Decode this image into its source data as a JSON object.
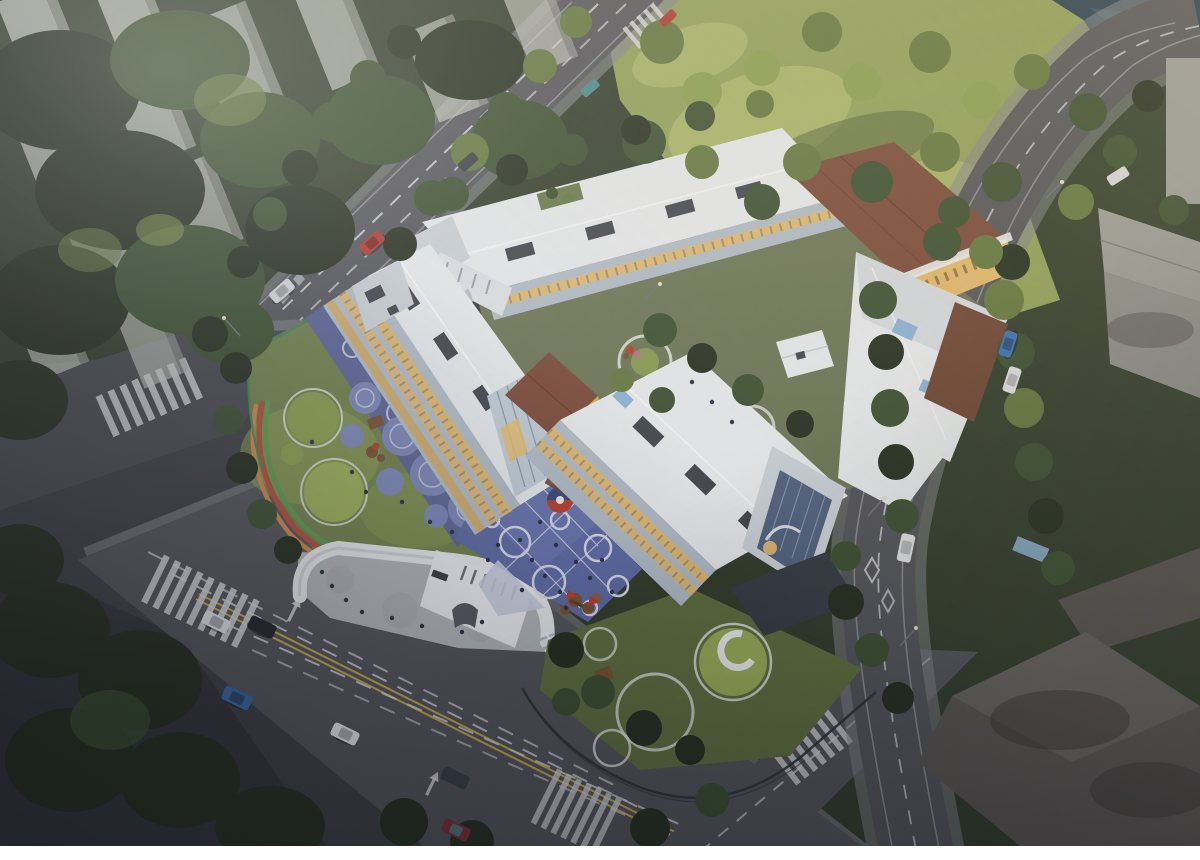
{
  "scene": {
    "description": "Aerial dusk rendering of a kindergarten campus: white pitched-roof wings around a courtyard, brown and yellow accent volumes, blue play court with white circles, circular play lawn with grass mounds and running track, curved white entrance gate with glass corridor, tree-lined roads with cars, ghosted residential towers, sunlit park with water edge, dark slab buildings",
    "time_of_day": "dusk",
    "text_content": "none"
  },
  "palette": {
    "asphalt": "#4b4c50",
    "plaza_dark": "#404145",
    "road": "#55565a",
    "road_edge": "#77797d",
    "sidewalk": "#84878a",
    "plaza_light": "#b3b6b8",
    "park": "#93a259",
    "park_sun": "#aeba6a",
    "park_shadow": "#55633a",
    "lawn": "#73824b",
    "lawn_sun": "#8ea353",
    "garden": "#60713f",
    "courtyard": "#6d7655",
    "tree_dark": "#26301f",
    "tree_mid": "#3c5030",
    "tree_lit": "#65783e",
    "tree_sun": "#8da050",
    "roof_white": "#e9eced",
    "roof_shade": "#d2d7db",
    "facade": "#b3bec7",
    "facade_light": "#ccd3d8",
    "facade_dark": "#98a3ad",
    "window_warm": "#e4ba6b",
    "dormer": "#41464c",
    "roof_brown": "#7b4a38",
    "wood": "#6f4733",
    "yellow": "#d9b14a",
    "glass": "#c3cfd7",
    "glass_blue": "#53637f",
    "skylight": "#8fb4d4",
    "court": "#5f6ca5",
    "pad": "#7d89b6",
    "pad_walk": "#5a64a0",
    "court_line": "#d9dde9",
    "court_white": "#c9cfdf",
    "track_red": "#b2503e",
    "track_green": "#5f9c4f",
    "track_orange": "#cc8a4a",
    "fence_green": "#3f8a52",
    "fence_dark": "#2e3338",
    "water": "#27404f",
    "water_light": "#3f6173",
    "tower": "#c7cac2",
    "tower_side": "#a3a69e",
    "mark_white": "#d9dadc",
    "mark_yellow": "#c4a94e",
    "slab": "#5a5651",
    "slab_light": "#6b6761",
    "bldg_gray": "#90918c",
    "bldg_gray_light": "#9d9e99",
    "mound": "#8ba04f",
    "mound_sun": "#9cb058",
    "ring_white": "#e3e7e3",
    "equip_brown": "#7a5232",
    "equip_red": "#b8402e",
    "people": "#2b3140",
    "glow": "#e8c070",
    "canopy_dark": "#383d44",
    "corridor": "#dfe5e9",
    "corridor_rib": "#9fb0b8",
    "car_red": "#b03830",
    "car_silver": "#d8dadc",
    "car_dark": "#3a3f46",
    "car_teal": "#4a8a8c",
    "car_white": "#e3e5e7",
    "car_black": "#24262a",
    "car_blue": "#3a6aa0",
    "car_maroon": "#7e3034",
    "car_blue2": "#3a72b8",
    "white_bar": "#ffffff"
  }
}
